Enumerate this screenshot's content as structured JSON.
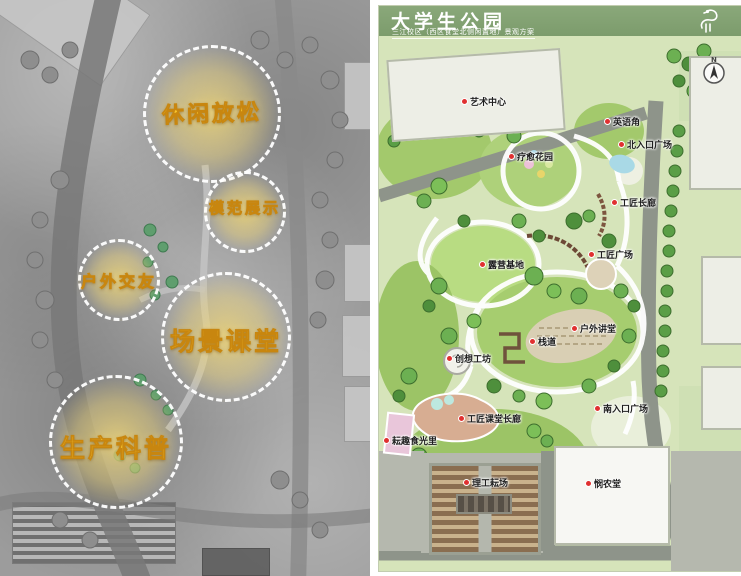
{
  "left_panel": {
    "zones": [
      {
        "label": "休闲放松"
      },
      {
        "label": "模范展示"
      },
      {
        "label": "户外交友"
      },
      {
        "label": "场景课堂"
      },
      {
        "label": "生产科普"
      }
    ]
  },
  "right_panel": {
    "title": "大学生公园",
    "subtitle": "三江校区（西区食堂北侧闲置地）景观方案",
    "compass_label": "N",
    "labels": [
      {
        "name": "艺术中心"
      },
      {
        "name": "英语角"
      },
      {
        "name": "北入口广场"
      },
      {
        "name": "疗愈花园"
      },
      {
        "name": "工匠长廊"
      },
      {
        "name": "露营基地"
      },
      {
        "name": "工匠广场"
      },
      {
        "name": "户外讲堂"
      },
      {
        "name": "栈道"
      },
      {
        "name": "创想工坊"
      },
      {
        "name": "南入口广场"
      },
      {
        "name": "工匠课堂长廊"
      },
      {
        "name": "耘趣食光里"
      },
      {
        "name": "理工耘场"
      },
      {
        "name": "悯农堂"
      }
    ]
  },
  "colors": {
    "header_green": "#7c9c6c",
    "zone_yellow": "#f8c62e",
    "label_dot_red": "#e03030",
    "lawn_green": "#a6cd6f",
    "road_gray": "#8e948a"
  }
}
